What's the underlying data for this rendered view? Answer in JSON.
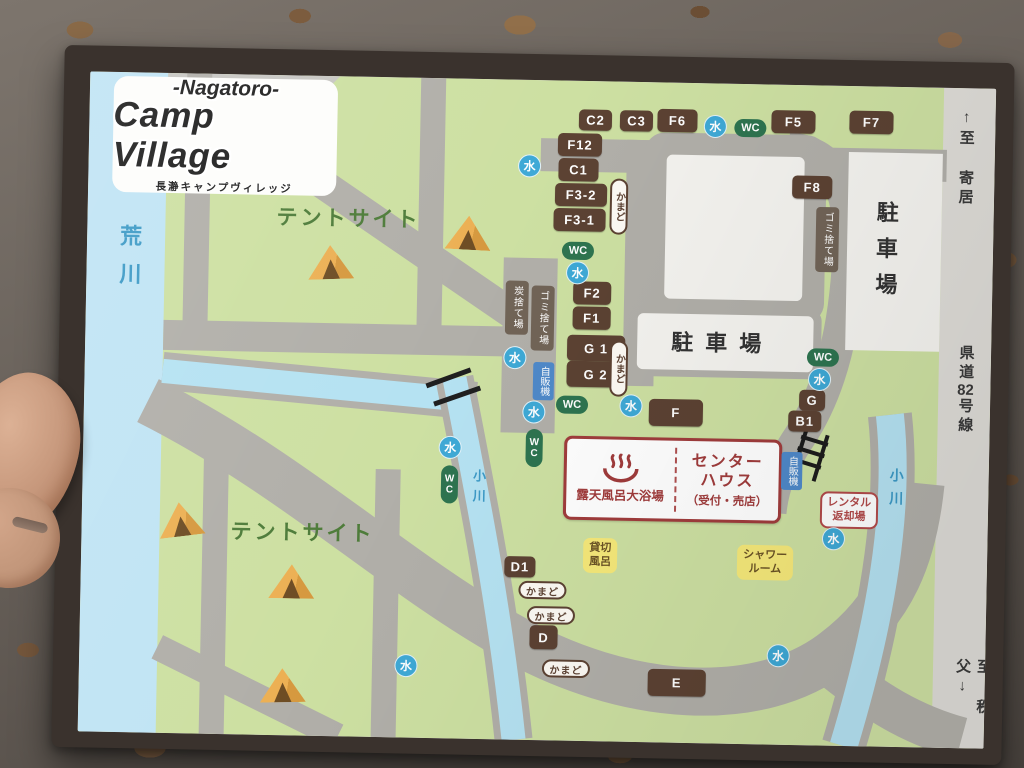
{
  "map": {
    "title": {
      "line1": "-Nagatoro-",
      "line2": "Camp Village",
      "subtitle": "長瀞キャンプヴィレッジ"
    },
    "water_char": "水",
    "wc_char": "WC",
    "kamado_label": "かまど",
    "colors": {
      "site_badge": "#5c4233",
      "water": "#3fa9d6",
      "wc": "#2e7450",
      "vending": "#4f89c9",
      "grass": "#cde0a2",
      "road": "#b1afa9",
      "river": "#c0e4f4",
      "parking": "#f4f3ef",
      "sign_red": "#a03c3c",
      "facility_yellow": "#f6e97a"
    },
    "badges": [
      {
        "label": "C2",
        "x": 506,
        "y": 39,
        "w": 33,
        "h": 21
      },
      {
        "label": "C3",
        "x": 547,
        "y": 39,
        "w": 33,
        "h": 21
      },
      {
        "label": "F6",
        "x": 588,
        "y": 38,
        "w": 40,
        "h": 23
      },
      {
        "label": "F5",
        "x": 704,
        "y": 37,
        "w": 44,
        "h": 23
      },
      {
        "label": "F7",
        "x": 782,
        "y": 36,
        "w": 44,
        "h": 23
      },
      {
        "label": "F12",
        "x": 491,
        "y": 64,
        "w": 44,
        "h": 23
      },
      {
        "label": "C1",
        "x": 490,
        "y": 89,
        "w": 40,
        "h": 23
      },
      {
        "label": "F3-2",
        "x": 493,
        "y": 114,
        "w": 52,
        "h": 23
      },
      {
        "label": "F3-1",
        "x": 492,
        "y": 139,
        "w": 52,
        "h": 23
      },
      {
        "label": "F8",
        "x": 724,
        "y": 102,
        "w": 40,
        "h": 23
      },
      {
        "label": "F2",
        "x": 506,
        "y": 212,
        "w": 38,
        "h": 23
      },
      {
        "label": "F1",
        "x": 506,
        "y": 237,
        "w": 38,
        "h": 23
      },
      {
        "label": "G 1",
        "x": 511,
        "y": 267,
        "w": 58,
        "h": 26
      },
      {
        "label": "G 2",
        "x": 511,
        "y": 293,
        "w": 58,
        "h": 26
      },
      {
        "label": "F",
        "x": 592,
        "y": 330,
        "w": 54,
        "h": 27
      },
      {
        "label": "G",
        "x": 728,
        "y": 315,
        "w": 26,
        "h": 21
      },
      {
        "label": "B1",
        "x": 721,
        "y": 336,
        "w": 33,
        "h": 21
      },
      {
        "label": "D1",
        "x": 439,
        "y": 487,
        "w": 31,
        "h": 21
      },
      {
        "label": "D",
        "x": 464,
        "y": 557,
        "w": 28,
        "h": 24
      },
      {
        "label": "E",
        "x": 598,
        "y": 600,
        "w": 58,
        "h": 27
      }
    ],
    "water_markers": [
      {
        "x": 626,
        "y": 43
      },
      {
        "x": 441,
        "y": 86
      },
      {
        "x": 491,
        "y": 192
      },
      {
        "x": 430,
        "y": 278
      },
      {
        "x": 450,
        "y": 332
      },
      {
        "x": 547,
        "y": 324
      },
      {
        "x": 367,
        "y": 369
      },
      {
        "x": 735,
        "y": 294
      },
      {
        "x": 752,
        "y": 453
      },
      {
        "x": 327,
        "y": 588
      },
      {
        "x": 699,
        "y": 571
      }
    ],
    "wc_markers": [
      {
        "x": 661,
        "y": 44,
        "o": "h"
      },
      {
        "x": 491,
        "y": 170,
        "o": "h"
      },
      {
        "x": 738,
        "y": 272,
        "o": "h"
      },
      {
        "x": 488,
        "y": 324,
        "o": "h"
      },
      {
        "x": 451,
        "y": 368,
        "o": "v"
      },
      {
        "x": 367,
        "y": 406,
        "o": "v"
      }
    ],
    "kamado_markers": [
      {
        "x": 531,
        "y": 125,
        "o": "v"
      },
      {
        "x": 534,
        "y": 287,
        "o": "v"
      },
      {
        "x": 462,
        "y": 510,
        "o": "h"
      },
      {
        "x": 471,
        "y": 535,
        "o": "h"
      },
      {
        "x": 487,
        "y": 588,
        "o": "h"
      }
    ],
    "utility_labels": [
      {
        "text": "ゴミ捨て場",
        "x": 740,
        "y": 154
      },
      {
        "text": "ゴミ捨て場",
        "x": 457,
        "y": 238
      },
      {
        "text": "炭捨て場",
        "x": 431,
        "y": 228
      }
    ],
    "vending_labels": [
      {
        "text": "自販機",
        "x": 459,
        "y": 301
      },
      {
        "text": "自販機",
        "x": 709,
        "y": 386
      }
    ],
    "yellow_labels": [
      {
        "lines": [
          "貸切",
          "風呂"
        ],
        "x": 519,
        "y": 474
      },
      {
        "lines": [
          "シャワー",
          "ルーム"
        ],
        "x": 684,
        "y": 478
      }
    ],
    "center_house": {
      "caption": "露天風呂大浴場",
      "name_line1": "センター",
      "name_line2": "ハウス",
      "name_line3": "（受付・売店）"
    },
    "rental": {
      "line1": "レンタル",
      "line2": "返却場"
    },
    "parking_labels": [
      {
        "text": "駐車場",
        "x": 798,
        "y": 168,
        "o": "v"
      },
      {
        "text": "駐車場",
        "x": 637,
        "y": 258,
        "o": "h"
      }
    ],
    "river_labels": [
      {
        "text": "荒川",
        "x": 42,
        "y": 190,
        "fs": 22,
        "ls": 16
      },
      {
        "text": "小川",
        "x": 396,
        "y": 410,
        "fs": 13,
        "ls": 7
      },
      {
        "text": "小川",
        "x": 814,
        "y": 404,
        "fs": 14,
        "ls": 9
      }
    ],
    "tent_site_labels": [
      {
        "text": "テントサイト",
        "x": 261,
        "y": 141
      },
      {
        "text": "テントサイト",
        "x": 221,
        "y": 456
      }
    ],
    "road_labels": [
      {
        "text": "↑至 寄居",
        "x": 877,
        "y": 70
      },
      {
        "text": "県道82号線",
        "x": 881,
        "y": 302
      },
      {
        "text": "至 秩父↓",
        "x": 894,
        "y": 600
      }
    ],
    "tents": [
      {
        "x": 244,
        "y": 186,
        "r": -3
      },
      {
        "x": 381,
        "y": 154,
        "r": 2
      },
      {
        "x": 99,
        "y": 446,
        "r": -8
      },
      {
        "x": 211,
        "y": 506,
        "r": 0
      },
      {
        "x": 204,
        "y": 610,
        "r": -2
      }
    ]
  }
}
